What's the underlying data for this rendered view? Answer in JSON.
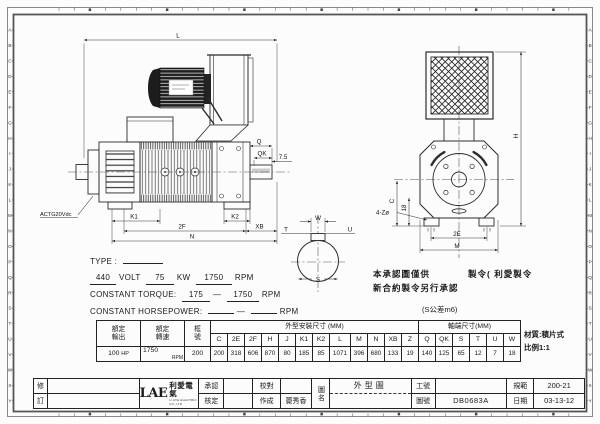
{
  "border": {
    "letters": "ABCDEFGHIJKLMNOPQRSTUVWXY"
  },
  "dims": {
    "L": "L",
    "Q": "Q",
    "QK": "QK",
    "shaft_gap": "7.5",
    "K1": "K1",
    "K2": "K2",
    "twoF": "2F",
    "XB": "XB",
    "N": "N",
    "W": "W",
    "T": "T",
    "U": "U",
    "S": "S",
    "H": "H",
    "C": "C",
    "eighteen": "18",
    "holes": "4-Zø",
    "twoE": "2E",
    "M": "M",
    "tacho": "ACTG20Vdc"
  },
  "specs": {
    "type_label": "TYPE :",
    "volt_value": "440",
    "volt_label": "VOLT",
    "kw_value": "75",
    "kw_label": "KW",
    "rpm_value": "1750",
    "rpm_label": "RPM",
    "torque_label": "CONSTANT TORQUE:",
    "torque_from": "175",
    "torque_dash": "—",
    "torque_to": "1750",
    "torque_unit": "RPM",
    "hp_label": "CONSTANT HORSEPOWER:",
    "hp_dash": "—",
    "hp_unit": "RPM"
  },
  "note": {
    "line1_pre": "本承認圖僅供",
    "line1_post": "製令( 利愛製令",
    "line2": "新合約製令另行承認",
    "tolerance": "(S公差m6)"
  },
  "aside": {
    "material": "材質:積片式",
    "scale": "比例1:1"
  },
  "table": {
    "h_output": "額定\n輸出",
    "h_speed": "額定\n轉速",
    "h_frame": "框\n號",
    "h_outline": "外型安裝尺寸 (MM)",
    "h_shaft": "軸端尺寸(MM)",
    "dim_headers": [
      "C",
      "2E",
      "2F",
      "H",
      "J",
      "K1",
      "K2",
      "L",
      "M",
      "N",
      "XB",
      "Z",
      "Q",
      "QK",
      "S",
      "T",
      "U",
      "W"
    ],
    "output_value": "100",
    "output_unit": "HP",
    "speed_value": "1750",
    "speed_unit": "RPM",
    "frame_value": "200",
    "dim_values": [
      "200",
      "318",
      "606",
      "870",
      "80",
      "185",
      "85",
      "1071",
      "396",
      "680",
      "133",
      "19",
      "140",
      "125",
      "65",
      "12",
      "7",
      "18"
    ]
  },
  "titleblock": {
    "rev_top": "修",
    "rev_bottom": "訂",
    "logo_main": "LAE",
    "logo_cn": "利愛電氣",
    "logo_sub": "LI AYE ELECTRIC CO.,LTD",
    "approve": "承認",
    "proof": "校對",
    "check": "核定",
    "made": "作成",
    "made_by": "薨秀香",
    "name_label": "圖名",
    "drawing_name": "外型圖",
    "work_label": "工號",
    "work_no": "",
    "dwg_label": "圖號",
    "dwg_no": "DB0683A",
    "spec_label": "規範",
    "spec_no": "200-21",
    "date_label": "日期",
    "date": "03-13-12"
  }
}
